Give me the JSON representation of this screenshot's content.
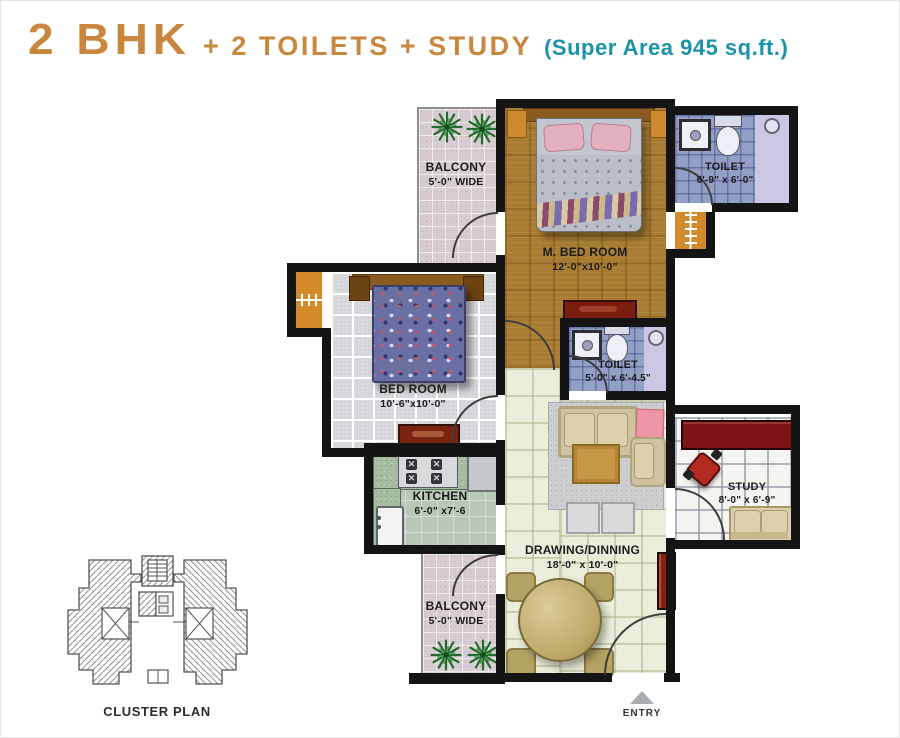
{
  "title": {
    "main": "2 BHK",
    "features": "+ 2 TOILETS + STUDY",
    "area": "(Super Area 945 sq.ft.)"
  },
  "rooms": {
    "balcony_top": {
      "name": "BALCONY",
      "dim": "5'-0\" WIDE"
    },
    "master_bedroom": {
      "name": "M. BED ROOM",
      "dim": "12'-0\"x10'-0\""
    },
    "toilet_top": {
      "name": "TOILET",
      "dim": "6'-9\" x 6'-0\""
    },
    "bedroom": {
      "name": "BED ROOM",
      "dim": "10'-6\"x10'-0\""
    },
    "toilet_mid": {
      "name": "TOILET",
      "dim": "5'-0\" x 6'-4.5\""
    },
    "kitchen": {
      "name": "KITCHEN",
      "dim": "6'-0\" x7'-6"
    },
    "drawing_dining": {
      "name": "DRAWING/DINNING",
      "dim": "18'-0\" x 10'-0\""
    },
    "study": {
      "name": "STUDY",
      "dim": "8'-0\" x 6'-9\""
    },
    "balcony_bottom": {
      "name": "BALCONY",
      "dim": "5'-0\" WIDE"
    }
  },
  "footer": {
    "cluster_plan_label": "CLUSTER PLAN",
    "entry_label": "ENTRY"
  },
  "colors": {
    "title_orange": "#c8873c",
    "title_teal": "#1d93a8",
    "wall_black": "#141414",
    "wood_floor": "#a87c33",
    "toilet_tile": "#93a0c6",
    "shower_lavender": "#c9c7e3",
    "kitchen_floor": "#b7c9b6",
    "living_floor": "#ebeeda",
    "balcony_floor": "#d6ccd2",
    "bedroom_floor": "#d8d9dd",
    "study_accent_red": "#7a1216",
    "wardrobe_orange": "#d28a2b",
    "plant_green": "#236b2d"
  }
}
